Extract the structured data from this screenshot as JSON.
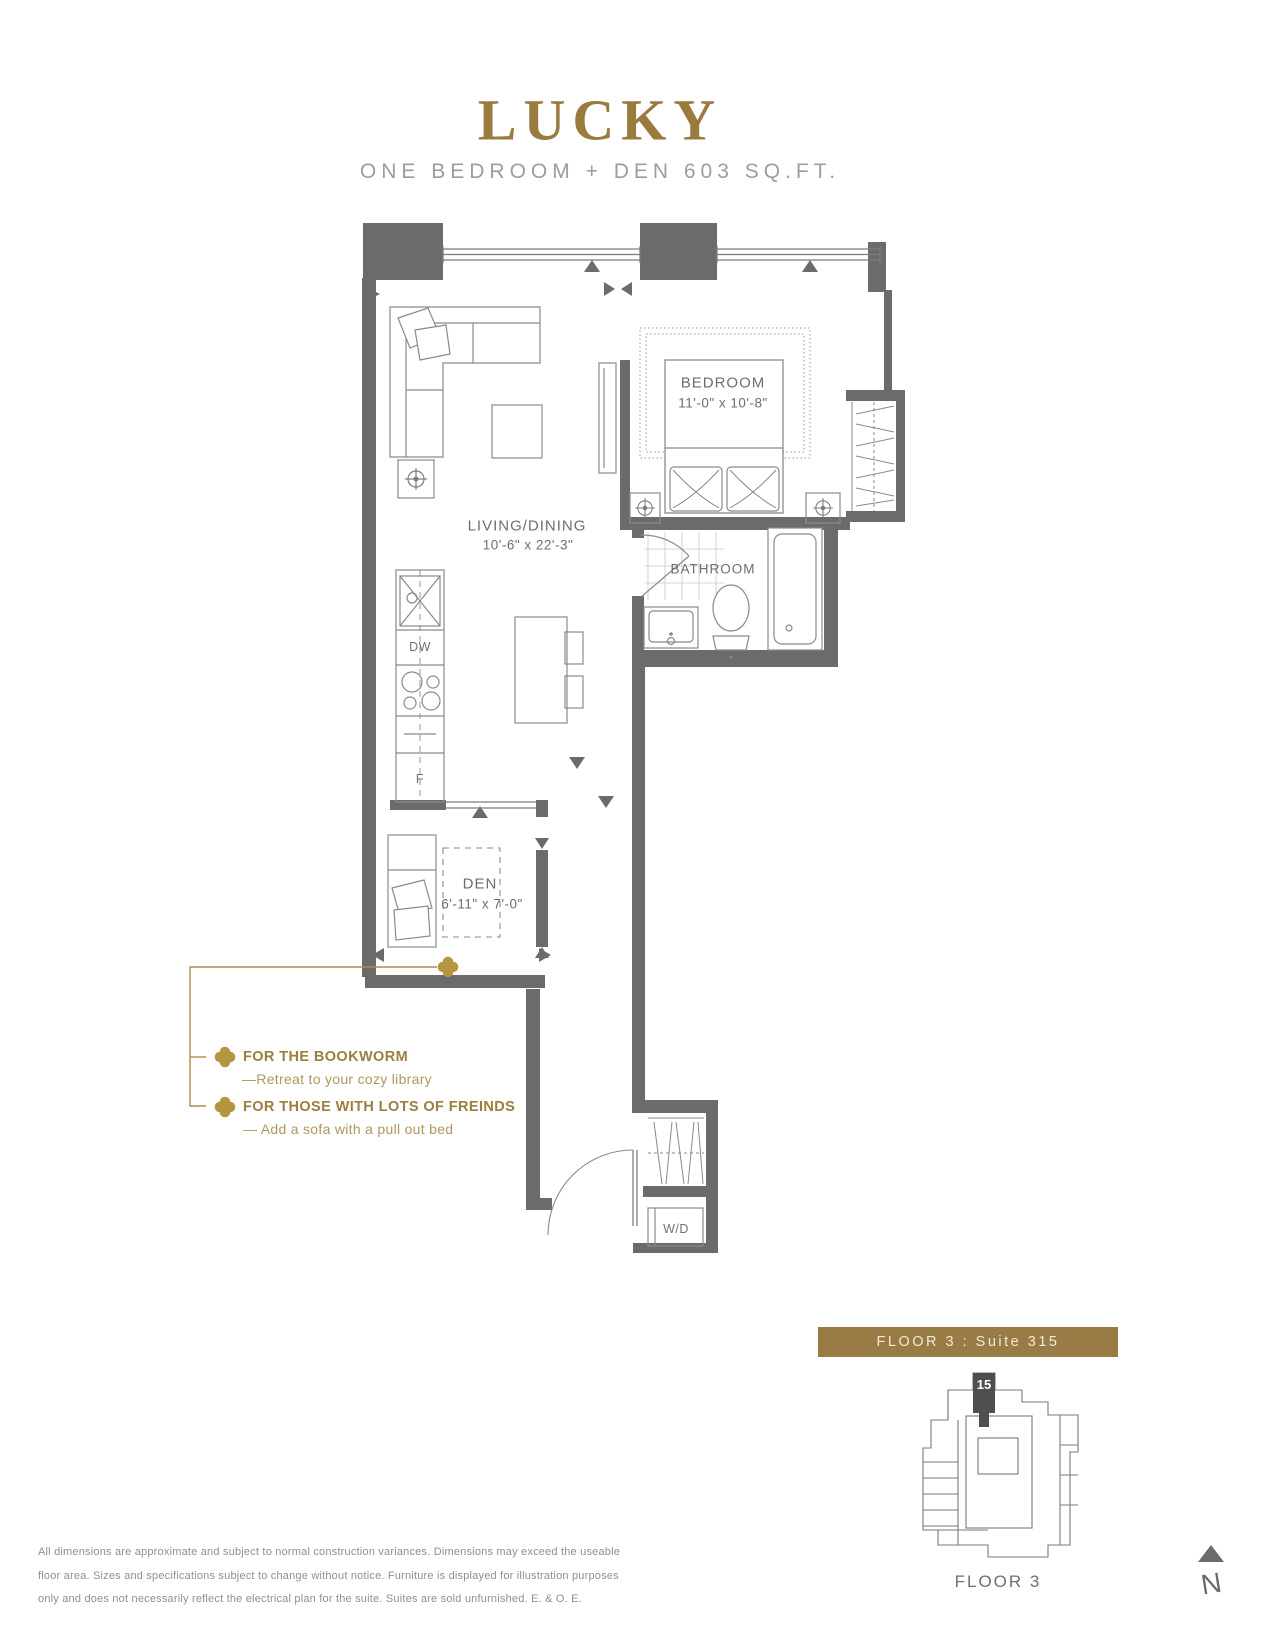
{
  "header": {
    "title": "LUCKY",
    "subtitle": "ONE BEDROOM + DEN 603 SQ.FT."
  },
  "plan": {
    "bedroom": {
      "name": "BEDROOM",
      "dims": "11'-0\" x 10'-8\""
    },
    "living": {
      "name": "LIVING/DINING",
      "dims": "10'-6\" x 22'-3\""
    },
    "bathroom": {
      "name": "BATHROOM"
    },
    "den": {
      "name": "DEN",
      "dims": "6'-11\" x 7'-0\""
    },
    "labels": {
      "dishwasher": "DW",
      "fridge": "F",
      "washer_dryer": "W/D"
    }
  },
  "annotations": {
    "bookworm": {
      "title": "FOR THE BOOKWORM",
      "desc": "—Retreat to your cozy library"
    },
    "friends": {
      "title": "FOR THOSE WITH LOTS OF FREINDS",
      "desc": "— Add a sofa with a pull out bed"
    }
  },
  "footer": {
    "banner": "FLOOR 3 : Suite 315",
    "keyplan_unit": "15",
    "keyplan_label": "FLOOR 3",
    "north": "N",
    "disclaimer_line1": "All dimensions are approximate and subject to normal construction variances. Dimensions may exceed the useable",
    "disclaimer_line2": "floor area. Sizes and specifications subject to change without notice. Furniture is displayed for illustration purposes",
    "disclaimer_line3": "only and does not necessarily reflect the electrical plan for the suite. Suites are sold unfurnished. E. & O. E."
  },
  "colors": {
    "title_gold": "#9a7b3e",
    "banner_gold": "#997c45",
    "clover_gold": "#b5953f",
    "wall_gray": "#6b6b6b"
  }
}
